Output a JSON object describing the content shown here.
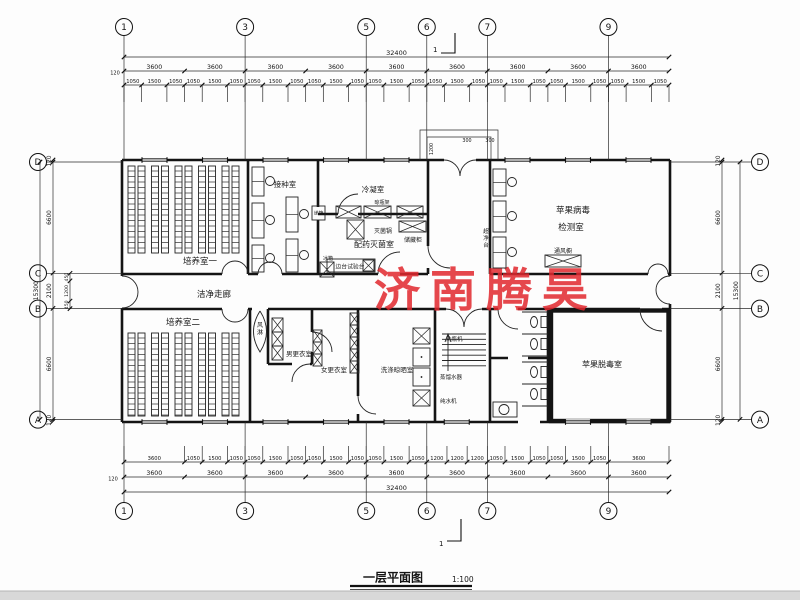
{
  "drawing": {
    "title": "一层平面图",
    "scale": "1:100",
    "watermark": "济南腾昊"
  },
  "axes": {
    "cols": [
      "1",
      "3",
      "5",
      "6",
      "7",
      "9"
    ],
    "rows": [
      "D",
      "C",
      "B",
      "A"
    ],
    "section_mark": "1"
  },
  "dims": {
    "top": {
      "overall": "32400",
      "edge": "120",
      "bays": [
        "3600",
        "3600",
        "3600",
        "3600",
        "3600",
        "3600",
        "3600",
        "3600",
        "3600"
      ],
      "details": [
        "1050",
        "1500",
        "1050",
        "1050",
        "1500",
        "1050",
        "1050",
        "1500",
        "1050",
        "1050",
        "1500",
        "1050",
        "1050",
        "1500",
        "1050",
        "1050",
        "1500",
        "1050",
        "1050",
        "1500",
        "1050",
        "1050",
        "1500",
        "1050",
        "1050",
        "1500",
        "1050"
      ]
    },
    "bottom": {
      "overall": "32400",
      "edge": "120",
      "bays": [
        "3600",
        "3600",
        "3600",
        "3600",
        "3600",
        "3600",
        "3600",
        "3600",
        "3600"
      ],
      "details": [
        "3600",
        "1050",
        "1500",
        "1050",
        "1050",
        "1500",
        "1050",
        "1050",
        "1500",
        "1050",
        "1050",
        "1500",
        "1050",
        "1200",
        "1200",
        "1200",
        "1050",
        "1500",
        "1050",
        "1050",
        "1500",
        "1050",
        "3600"
      ]
    },
    "left": {
      "overall": "15300",
      "edge_top": "120",
      "edge_bottom": "120",
      "segments": [
        "6600",
        "2100",
        "6600"
      ],
      "sub": [
        "450",
        "1200",
        "450"
      ]
    },
    "right": {
      "overall": "15300",
      "edge_top": "120",
      "edge_bottom": "120",
      "segments": [
        "6600",
        "2100",
        "6600"
      ]
    },
    "porch": [
      "1200",
      "300",
      "300"
    ]
  },
  "rooms": {
    "culture1": "培养室一",
    "inoculation": "接种室",
    "condensing": "冷凝室",
    "prep": "配药灭菌室",
    "test_line1": "苹果病毒",
    "test_line2": "检测室",
    "corridor": "洁净走廊",
    "culture2": "培养室二",
    "men": "男更衣室",
    "women": "女更衣室",
    "washing": "洗涤晾晒室",
    "detox": "苹果脱毒室"
  },
  "equipment": {
    "sterilizer": "灭菌锅",
    "cabinet": "储藏柜",
    "rack": "晾瓶架",
    "bench": "边台试验台",
    "fridge": "冰箱",
    "passbox": "递箱",
    "cleanbench": "超净台",
    "fumehood": "通风橱",
    "airshower": "风淋",
    "bottlewasher": "洗瓶机",
    "distiller": "蒸馏水器",
    "waterpurifier": "纯水机"
  }
}
